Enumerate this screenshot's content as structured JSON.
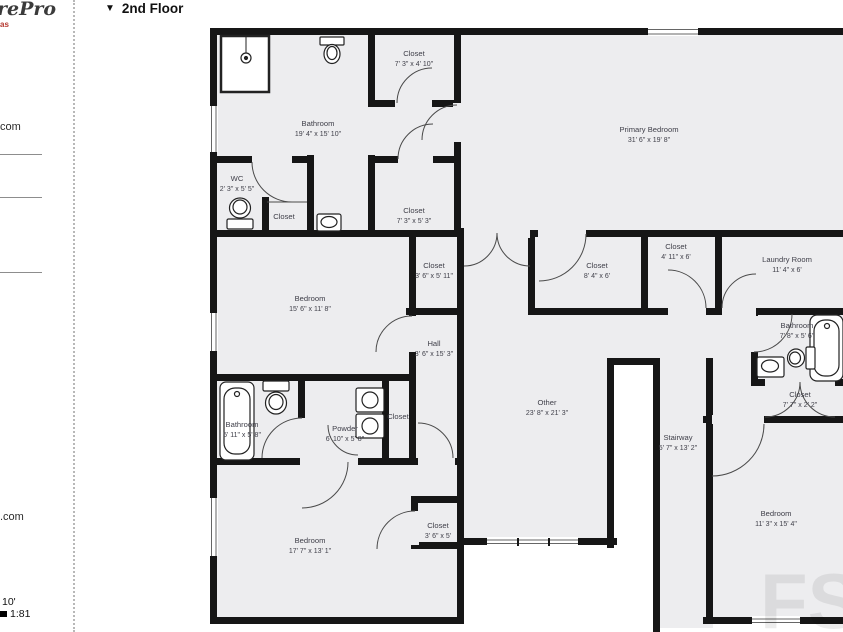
{
  "header": {
    "collapse_icon": "▼",
    "title": "2nd Floor"
  },
  "sidebar": {
    "logo": "rePro",
    "logo_sub": "as",
    "link_top": "com",
    "link_bottom": ".com",
    "scale_length": "10'",
    "scale_ratio": "1:81"
  },
  "watermark": "FS",
  "colors": {
    "wall": "#161616",
    "room_fill": "#ededef",
    "label": "#40404a",
    "accent_red": "#b5372e"
  },
  "rooms": [
    {
      "name": "Bathroom",
      "dims": "19' 4\" x 15' 10\""
    },
    {
      "name": "Closet",
      "dims": "7' 3\" x 4' 10\""
    },
    {
      "name": "Primary Bedroom",
      "dims": "31' 6\" x 19' 8\""
    },
    {
      "name": "WC",
      "dims": "2' 3\" x 5' 5\""
    },
    {
      "name": "Closet",
      "dims": ""
    },
    {
      "name": "Closet",
      "dims": "7' 3\" x 5' 3\""
    },
    {
      "name": "Closet",
      "dims": "3' 6\" x 5' 11\""
    },
    {
      "name": "Closet",
      "dims": "8' 4\" x 6'"
    },
    {
      "name": "Closet",
      "dims": "4' 11\" x 6'"
    },
    {
      "name": "Laundry Room",
      "dims": "11' 4\" x 6'"
    },
    {
      "name": "Bedroom",
      "dims": "15' 6\" x 11' 8\""
    },
    {
      "name": "Hall",
      "dims": "3' 6\" x 15' 3\""
    },
    {
      "name": "Bathroom",
      "dims": "7' 8\" x 5' 6\""
    },
    {
      "name": "Closet",
      "dims": "7' 7\" x 2' 2\""
    },
    {
      "name": "Bathroom",
      "dims": "5' 11\" x 5' 8\""
    },
    {
      "name": "Powder",
      "dims": "6' 10\" x 5' 8\""
    },
    {
      "name": "Closet",
      "dims": ""
    },
    {
      "name": "Other",
      "dims": "23' 8\" x 21' 3\""
    },
    {
      "name": "Stairway",
      "dims": "5' 7\" x 13' 2\""
    },
    {
      "name": "Bedroom",
      "dims": "17' 7\" x 13' 1\""
    },
    {
      "name": "Closet",
      "dims": "3' 6\" x 5'"
    },
    {
      "name": "Bedroom",
      "dims": "11' 3\" x 15' 4\""
    }
  ]
}
